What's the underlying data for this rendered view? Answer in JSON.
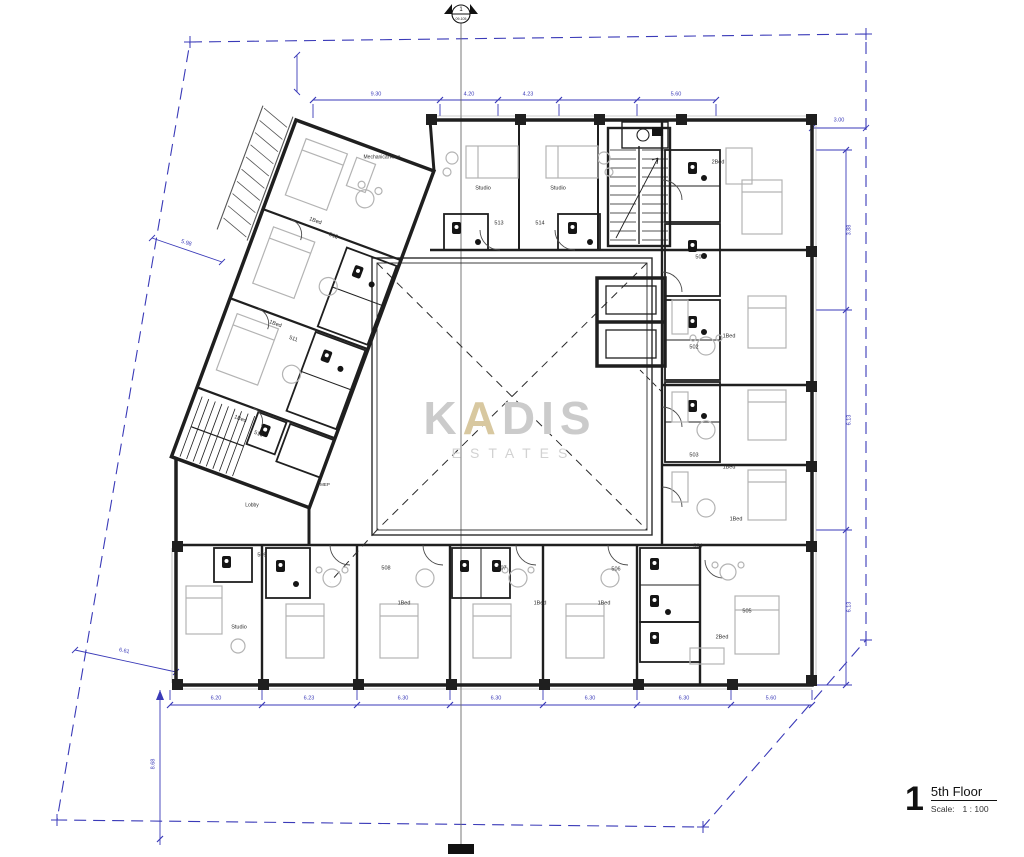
{
  "watermark": {
    "parts": [
      "K",
      "A",
      "DIS"
    ],
    "line2": "ESTATES"
  },
  "title_block": {
    "number": "1",
    "title": "5th Floor",
    "scale_label": "Scale:",
    "scale_value": "1 : 100"
  },
  "section_marker": {
    "number": "1",
    "sheet": "09-105"
  },
  "area_labels": {
    "mechanical": "Mechanical Area",
    "lobby": "Lobby",
    "mep": "MEP"
  },
  "rooms": [
    {
      "id": "501",
      "type": "2Bed"
    },
    {
      "id": "502",
      "type": "1Bed"
    },
    {
      "id": "503",
      "type": "1Bed"
    },
    {
      "id": "504",
      "type": "1Bed"
    },
    {
      "id": "505",
      "type": "2Bed"
    },
    {
      "id": "506",
      "type": "1Bed"
    },
    {
      "id": "507",
      "type": "1Bed"
    },
    {
      "id": "508",
      "type": "1Bed"
    },
    {
      "id": "509",
      "type": "Studio"
    },
    {
      "id": "510",
      "type": "1Bed"
    },
    {
      "id": "511",
      "type": "1Bed"
    },
    {
      "id": "512",
      "type": "1Bed"
    },
    {
      "id": "513",
      "type": "Studio"
    },
    {
      "id": "514",
      "type": "Studio"
    }
  ],
  "dimensions": {
    "top": [
      "9.30",
      "4.20",
      "4.23",
      "5.60"
    ],
    "top_right": "3.00",
    "right": [
      "3.88",
      "6.13",
      "6.13"
    ],
    "bottom": [
      "6.20",
      "6.23",
      "6.30",
      "6.30",
      "6.30",
      "6.30",
      "5.60"
    ],
    "left_upper": "5.98",
    "left_lower": "6.61",
    "left_vertical": "8.68"
  },
  "colors": {
    "dimension_blue": "#3a3ab8",
    "wall_black": "#1f1f1f",
    "furniture_gray": "#b3b3b3",
    "watermark_gold": "#d8c8a0"
  }
}
